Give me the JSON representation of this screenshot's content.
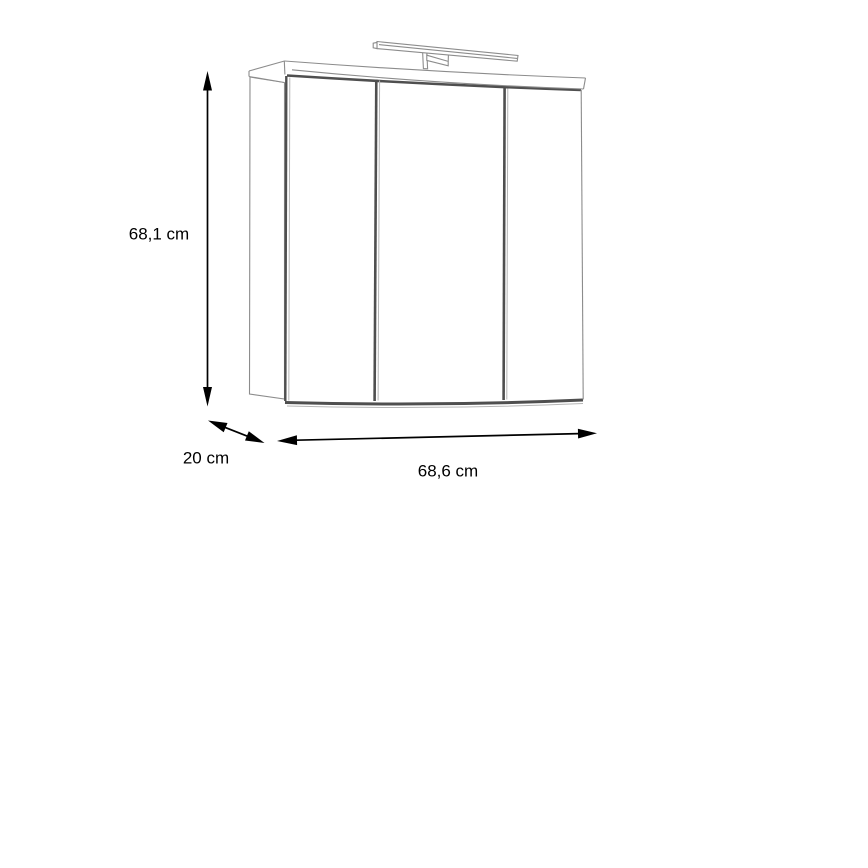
{
  "diagram": {
    "subject": "three-door mirror cabinet with top light bar",
    "door_count": 3,
    "dimensions": {
      "height": {
        "label": "68,1 cm"
      },
      "depth": {
        "label": "20 cm"
      },
      "width": {
        "label": "68,6 cm"
      }
    },
    "colors": {
      "background": "#ffffff",
      "outline_gray": "#8c8c8c",
      "edge_dark_gray": "#4f4f4f",
      "edge_light_gray": "#b5b5b5",
      "dimension_black": "#000000"
    }
  }
}
